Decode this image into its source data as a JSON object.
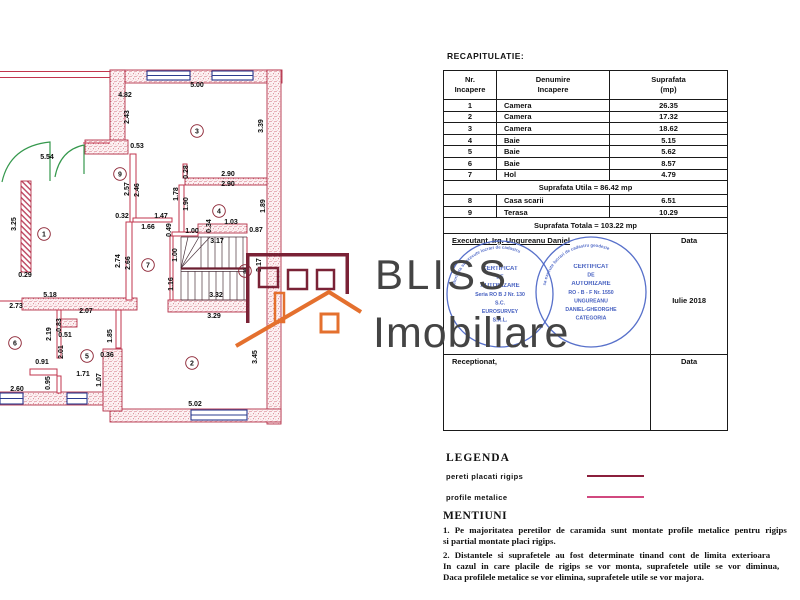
{
  "page_title": "RECAPITULATIE:",
  "recap_table": {
    "headers": [
      {
        "l1": "Nr.",
        "l2": "Incapere"
      },
      {
        "l1": "Denumire",
        "l2": "Incapere"
      },
      {
        "l1": "Suprafata",
        "l2": "(mp)"
      }
    ],
    "rows": [
      [
        "1",
        "Camera",
        "26.35"
      ],
      [
        "2",
        "Camera",
        "17.32"
      ],
      [
        "3",
        "Camera",
        "18.62"
      ],
      [
        "4",
        "Baie",
        "5.15"
      ],
      [
        "5",
        "Baie",
        "5.62"
      ],
      [
        "6",
        "Baie",
        "8.57"
      ],
      [
        "7",
        "Hol",
        "4.79"
      ]
    ],
    "suprafata_utila": "Suprafata Utila = 86.42 mp",
    "rows2": [
      [
        "8",
        "Casa scarii",
        "6.51"
      ],
      [
        "9",
        "Terasa",
        "10.29"
      ]
    ],
    "suprafata_totala": "Suprafata Totala = 103.22 mp",
    "executant_label": "Executant, Irg. Ungureanu Daniel",
    "data_label1": "Data",
    "stamp_date": "Iulie 2018",
    "receptionat_label": "Receptionat,",
    "data_label2": "Data"
  },
  "logo": {
    "name_top": "BLISS",
    "name_bottom": "Imobiliare",
    "maroon": "#7a2236",
    "orange": "#e4702e"
  },
  "stamps": [
    {
      "arc": "autorizata sa execute lucrari de cadastru",
      "lines": [
        "CERTIFICAT",
        "DE",
        "AUTORIZARE",
        "Seria RO B J Nr. 130",
        "S.C.",
        "EUROSURVEY",
        "S.R.L."
      ]
    },
    {
      "arc": "sa execute lucrari de cadastru geodezie",
      "lines": [
        "CERTIFICAT",
        "DE",
        "AUTORIZARE",
        "RO - B - F Nr. 1550",
        "UNGUREANU",
        "DANIEL-GHEORGHE",
        "CATEGORIA"
      ]
    }
  ],
  "legend": {
    "title": "LEGENDA",
    "items": [
      {
        "label": "pereti placati rigips",
        "color": "#8b1f3c"
      },
      {
        "label": "profile metalice",
        "color": "#d1487f"
      }
    ]
  },
  "mentiuni": {
    "title": "MENTIUNI",
    "lines": [
      "1. Pe majoritatea peretilor de caramida sunt montate profile metalice pentru rigips",
      "si partial montate placi rigips.",
      "2. Distantele si suprafetele au fost determinate tinand cont de limita exterioara",
      "In cazul in care placile de rigips se vor monta, suprafetele utile se vor diminua,",
      "Daca profilele metalice se vor elimina, suprafetele utile se vor majora."
    ]
  },
  "plan": {
    "dimensions": [
      [
        "4.82",
        125,
        97,
        0
      ],
      [
        "5.00",
        197,
        87,
        0
      ],
      [
        "2.43",
        129,
        117,
        1
      ],
      [
        "3.39",
        263,
        126,
        1
      ],
      [
        "0.53",
        137,
        148,
        0
      ],
      [
        "5.54",
        47,
        159,
        0
      ],
      [
        "3.25",
        16,
        224,
        1
      ],
      [
        "0.29",
        25,
        277,
        0
      ],
      [
        "0.28",
        188,
        172,
        1
      ],
      [
        "2.90",
        228,
        176,
        0
      ],
      [
        "2.90",
        228,
        186,
        0
      ],
      [
        "1.78",
        178,
        194,
        1
      ],
      [
        "1.90",
        188,
        204,
        1
      ],
      [
        "1.89",
        265,
        206,
        1
      ],
      [
        "2.57",
        129,
        189,
        1
      ],
      [
        "2.46",
        139,
        190,
        1
      ],
      [
        "0.32",
        122,
        218,
        0
      ],
      [
        "1.47",
        161,
        218,
        0
      ],
      [
        "1.66",
        148,
        229,
        0
      ],
      [
        "0.49",
        171,
        230,
        1
      ],
      [
        "1.00",
        192,
        233,
        0
      ],
      [
        "0.34",
        211,
        226,
        1
      ],
      [
        "1.03",
        231,
        224,
        0
      ],
      [
        "0.87",
        256,
        232,
        0
      ],
      [
        "3.17",
        217,
        243,
        0
      ],
      [
        "1.00",
        177,
        255,
        1
      ],
      [
        "2.17",
        261,
        265,
        1
      ],
      [
        "1.16",
        173,
        284,
        1
      ],
      [
        "3.32",
        216,
        297,
        0
      ],
      [
        "3.29",
        214,
        318,
        0
      ],
      [
        "2.74",
        120,
        261,
        1
      ],
      [
        "2.66",
        130,
        263,
        1
      ],
      [
        "5.18",
        50,
        297,
        0
      ],
      [
        "2.73",
        16,
        308,
        0
      ],
      [
        "2.07",
        86,
        313,
        0
      ],
      [
        "0.83",
        61,
        325,
        1
      ],
      [
        "2.19",
        51,
        334,
        1
      ],
      [
        "0.51",
        65,
        337,
        0
      ],
      [
        "1.85",
        112,
        336,
        1
      ],
      [
        "0.91",
        42,
        364,
        0
      ],
      [
        "2.01",
        63,
        352,
        1
      ],
      [
        "0.36",
        107,
        357,
        0
      ],
      [
        "0.95",
        50,
        383,
        1
      ],
      [
        "1.07",
        101,
        380,
        1
      ],
      [
        "1.71",
        83,
        376,
        0
      ],
      [
        "2.60",
        17,
        391,
        0
      ],
      [
        "3.45",
        257,
        357,
        1
      ],
      [
        "5.02",
        195,
        406,
        0
      ]
    ],
    "rooms": [
      [
        "9",
        120,
        174
      ],
      [
        "1",
        44,
        234
      ],
      [
        "3",
        197,
        131
      ],
      [
        "4",
        219,
        211
      ],
      [
        "7",
        148,
        265
      ],
      [
        "6",
        15,
        343
      ],
      [
        "5",
        87,
        356
      ],
      [
        "2",
        192,
        363
      ],
      [
        "8",
        245,
        271
      ]
    ]
  }
}
